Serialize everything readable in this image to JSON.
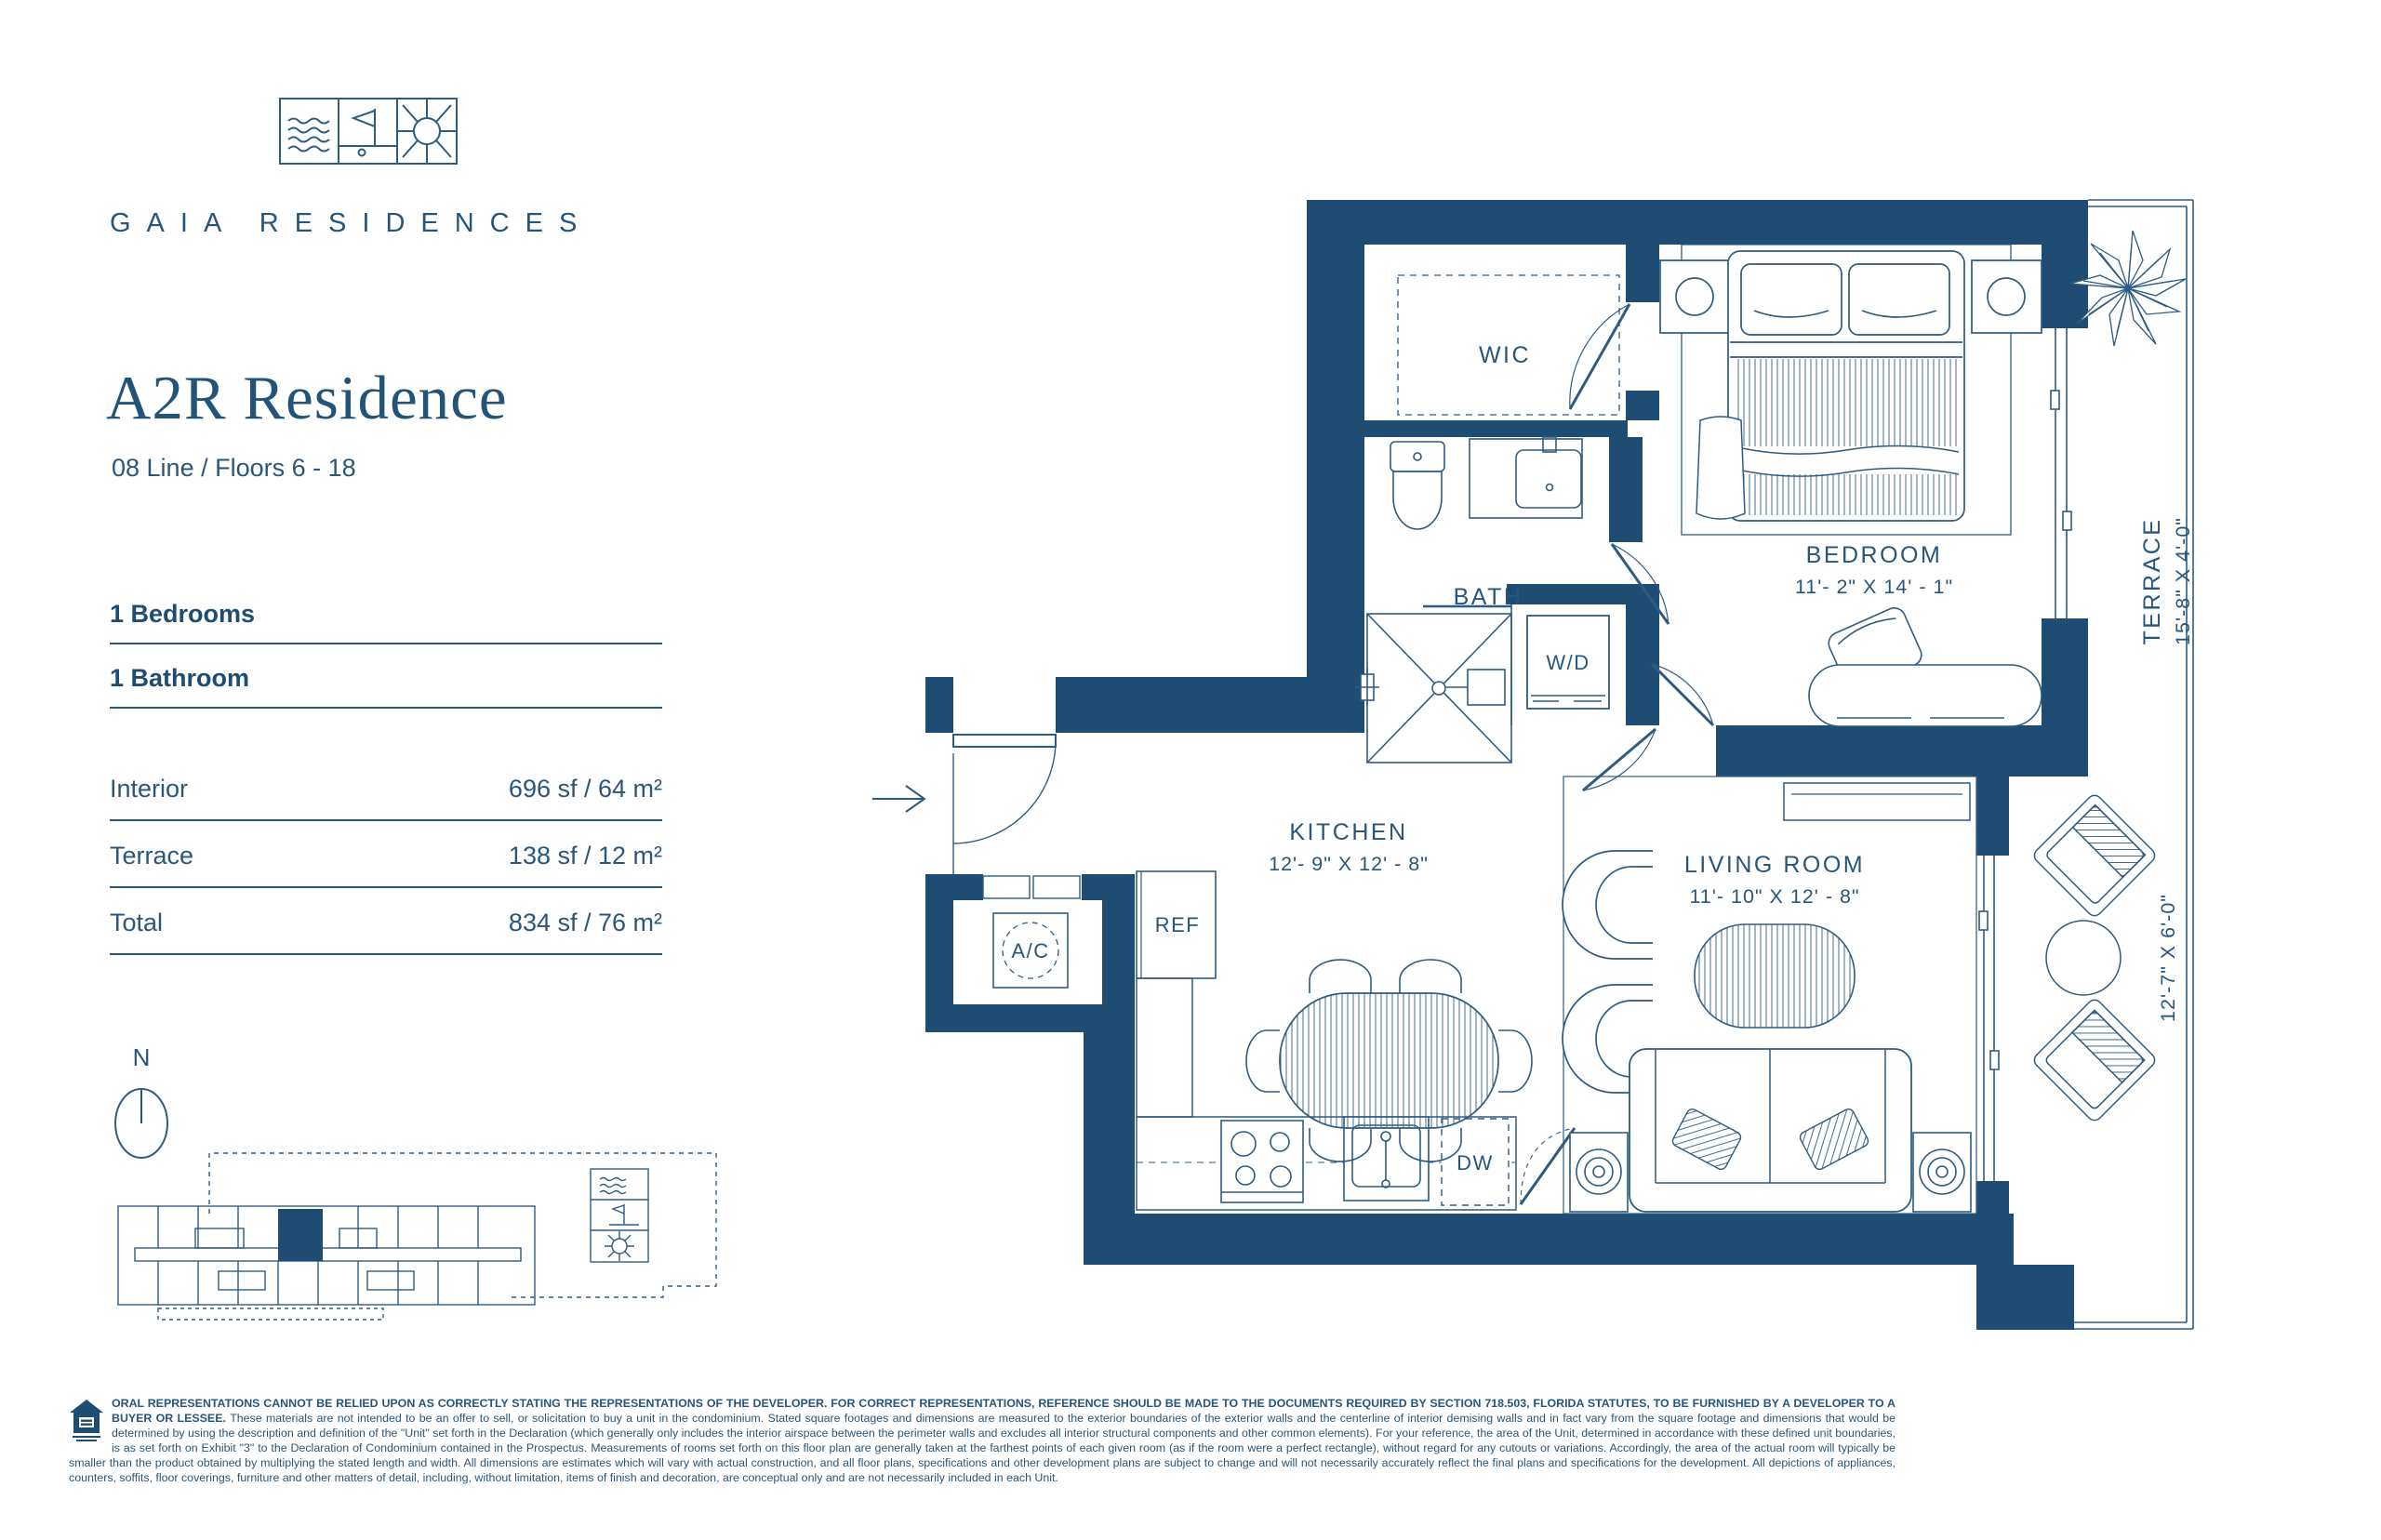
{
  "colors": {
    "navy": "#1e4c72",
    "line": "#2e5b82"
  },
  "brand": {
    "name": "GAIA RESIDENCES",
    "logo_icons": [
      "waves-icon",
      "golf-flag-icon",
      "sun-icon"
    ]
  },
  "unit": {
    "title": "A2R Residence",
    "line_info": "08 Line / Floors 6 - 18",
    "bedrooms": "1 Bedrooms",
    "bathrooms": "1 Bathroom"
  },
  "areas": [
    {
      "label": "Interior",
      "value": "696 sf / 64 m²"
    },
    {
      "label": "Terrace",
      "value": "138 sf / 12 m²"
    },
    {
      "label": "Total",
      "value": "834 sf / 76 m²"
    }
  ],
  "compass": {
    "north_label": "N"
  },
  "plan": {
    "wic": "WIC",
    "bath": "BATH",
    "wd": "W/D",
    "bedroom_name": "BEDROOM",
    "bedroom_dims": "11'- 2\" X 14' - 1\"",
    "kitchen_name": "KITCHEN",
    "kitchen_dims": "12'- 9\" X 12' - 8\"",
    "living_name": "LIVING ROOM",
    "living_dims": "11'- 10\" X 12' - 8\"",
    "terrace_name": "TERRACE",
    "terrace_dims": "15'-8\" X 4'-0\"",
    "terrace_side_dims": "12'-7\" X 6'-0\"",
    "ac": "A/C",
    "ref": "REF",
    "dw": "DW"
  },
  "disclaimer": {
    "bold": "ORAL REPRESENTATIONS CANNOT BE RELIED UPON AS CORRECTLY STATING THE REPRESENTATIONS OF THE DEVELOPER.  FOR CORRECT REPRESENTATIONS, REFERENCE SHOULD BE MADE TO THE DOCUMENTS REQUIRED BY SECTION 718.503, FLORIDA STATUTES, TO BE FURNISHED BY A DEVELOPER TO A BUYER OR LESSEE. ",
    "body": "These materials are not intended to be an offer to sell, or solicitation to buy a unit in the condominium.  Stated square footages and dimensions are measured to the exterior boundaries of the exterior walls and the centerline of interior demising walls and in fact vary from the square footage and dimensions that would be determined by using the description and definition of the \"Unit\" set forth in the Declaration (which generally only includes the interior airspace between the perimeter walls and excludes all interior structural components and other common elements). For your reference, the area of the Unit, determined in accordance with these defined unit boundaries, is as set forth on Exhibit \"3\" to the Declaration of Condominium contained in the Prospectus.  Measurements of rooms set forth on this floor plan are generally taken at the farthest points of each given room (as if the room were a perfect rectangle), without regard for any cutouts or variations. Accordingly, the area of the actual room will typically be smaller than the product obtained by multiplying the stated length and width. All dimensions are estimates which will vary with actual construction, and all floor plans, specifications and other development plans are subject to change and will not necessarily accurately reflect the final plans and specifications for the development. All depictions of appliances, counters, soffits, floor coverings, furniture and other matters of detail, including, without limitation, items of finish and decoration, are conceptual only and are not necessarily included in each Unit."
  }
}
